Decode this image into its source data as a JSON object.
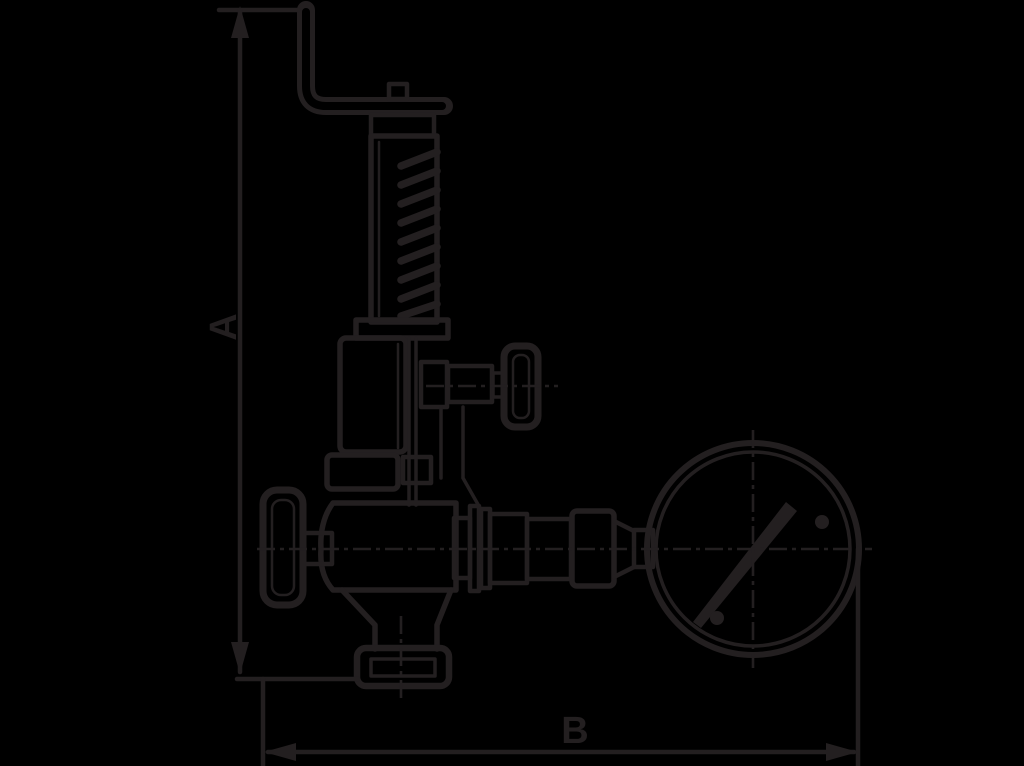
{
  "colors": {
    "background": "#000000",
    "line": "#231f20"
  },
  "diagram": {
    "type": "technical-line-drawing",
    "subject": "spring-loaded valve with hand knobs and pressure gauge, outline dimension drawing",
    "dimensions": {
      "a": {
        "label": "A",
        "axis": "vertical",
        "measures": "overall height from top of lever bracket to inlet flange face"
      },
      "b": {
        "label": "B",
        "axis": "horizontal",
        "measures": "overall width from valve left extension to gauge right edge"
      }
    },
    "components": [
      "top-lever-bracket",
      "adjusting-spring-column",
      "spring-bonnet",
      "side-port-hand-knob",
      "main-hand-wheel",
      "valve-body",
      "bottom-inlet-flange",
      "gauge-piping-fittings",
      "pressure-gauge-dial",
      "gauge-needle",
      "centerlines"
    ]
  }
}
